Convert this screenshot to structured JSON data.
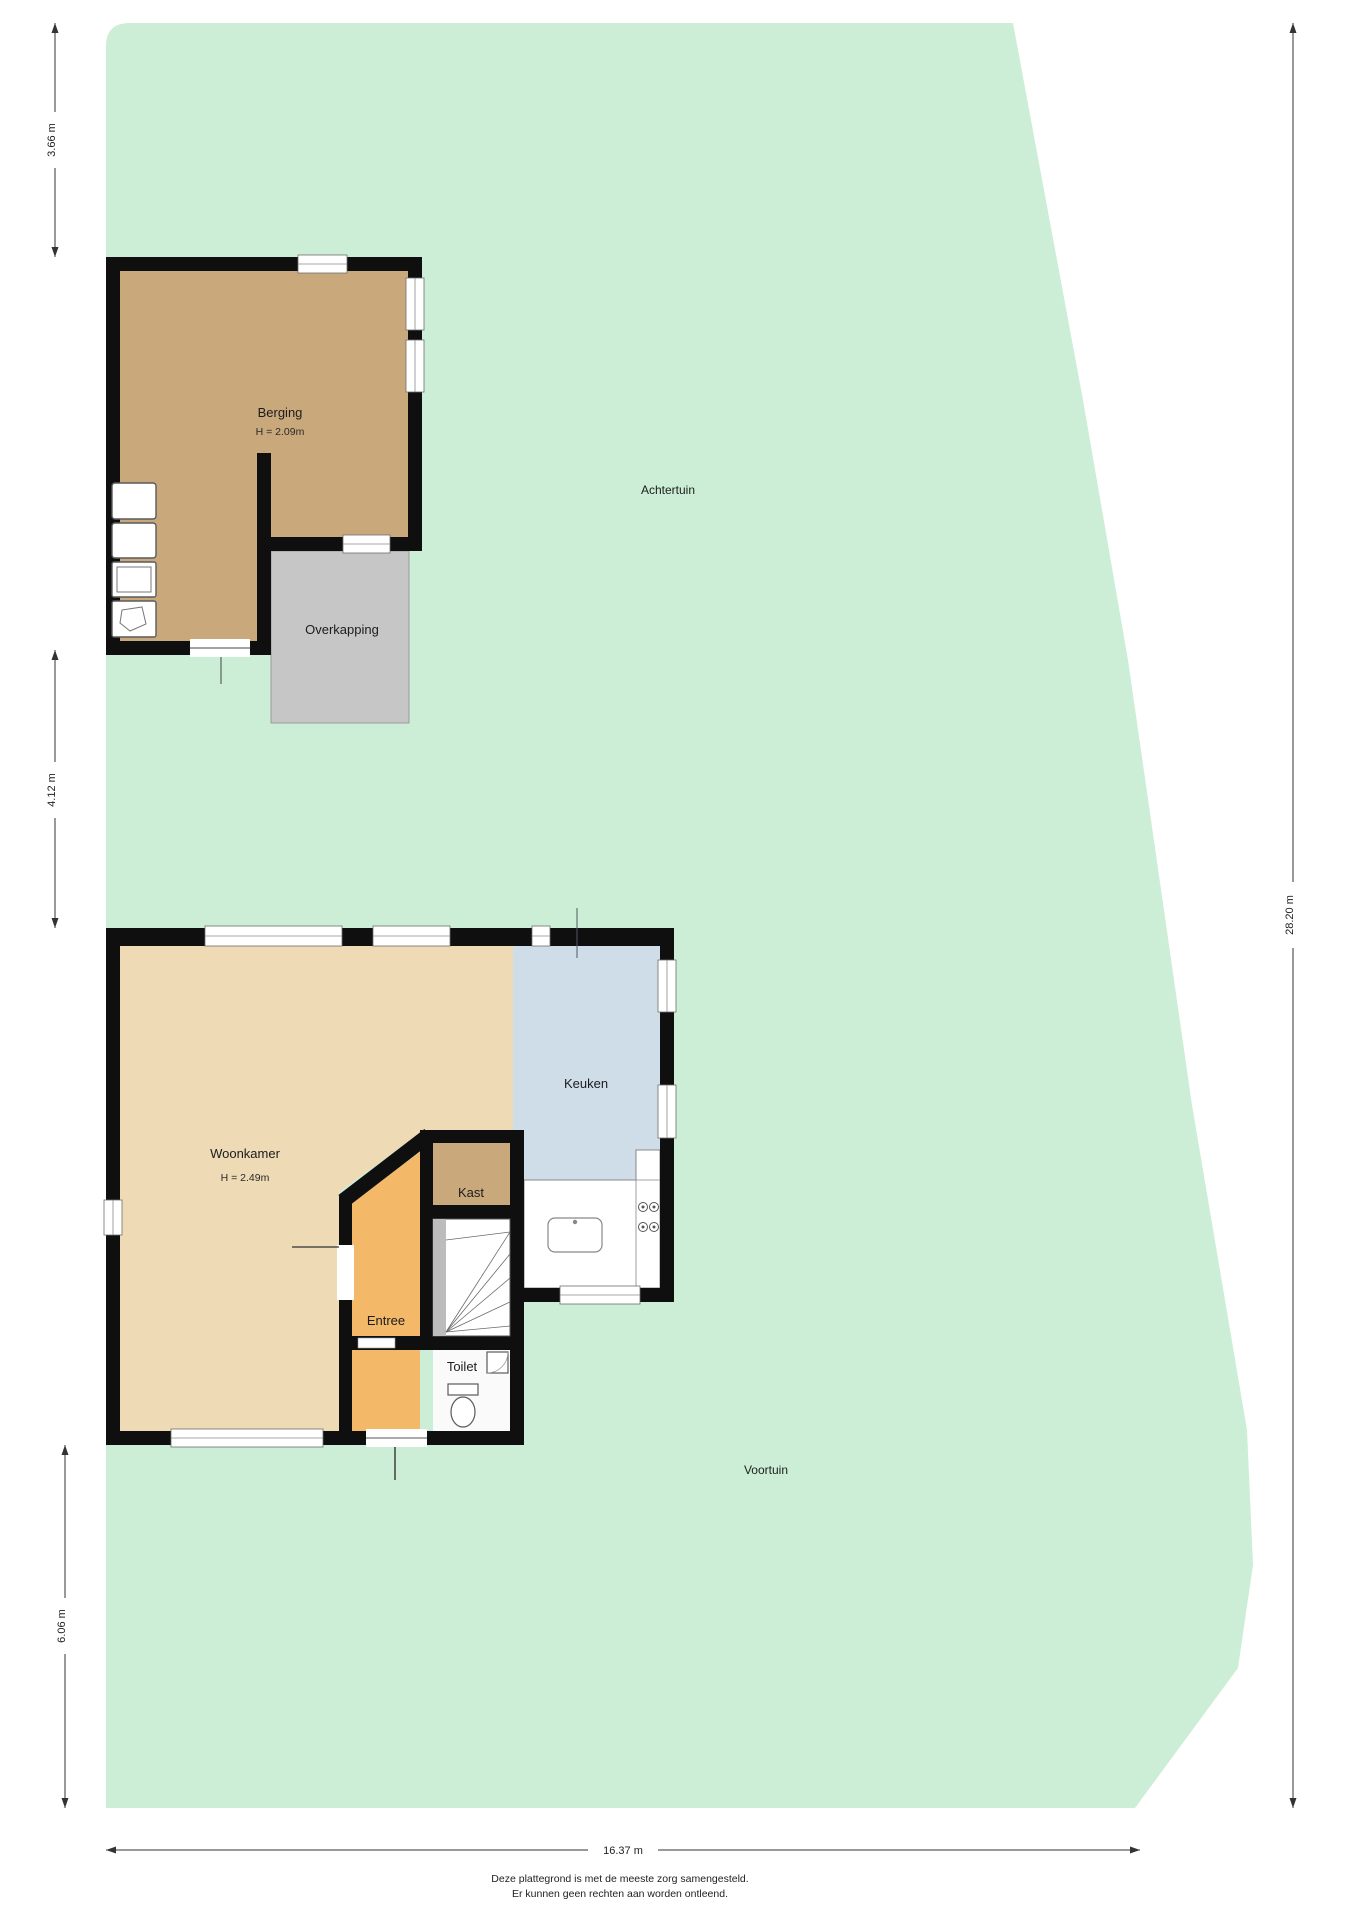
{
  "garden": {
    "back_label": "Achtertuin",
    "front_label": "Voortuin"
  },
  "rooms": {
    "berging": {
      "label": "Berging",
      "height_label": "H = 2.09m"
    },
    "overkapping": {
      "label": "Overkapping"
    },
    "woonkamer": {
      "label": "Woonkamer",
      "height_label": "H = 2.49m"
    },
    "keuken": {
      "label": "Keuken"
    },
    "kast": {
      "label": "Kast"
    },
    "entree": {
      "label": "Entree"
    },
    "toilet": {
      "label": "Toilet"
    }
  },
  "dimensions": {
    "left_top": "3.66 m",
    "left_middle": "4.12 m",
    "left_bottom": "6.06 m",
    "right": "28.20 m",
    "bottom": "16.37 m"
  },
  "footer": {
    "line1": "Deze plattegrond is met de meeste zorg samengesteld.",
    "line2": "Er kunnen geen rechten aan worden ontleend."
  },
  "colors": {
    "garden": "#cdeed6",
    "berging": "#c9a97b",
    "overkapping": "#c6c6c6",
    "woonkamer": "#eedab4",
    "keuken": "#cfdde9",
    "kast": "#c9a97b",
    "entree": "#f3b868",
    "toilet": "#fafafa",
    "wall": "#0f0f0f",
    "stairs_strip": "#bcbcbc"
  }
}
